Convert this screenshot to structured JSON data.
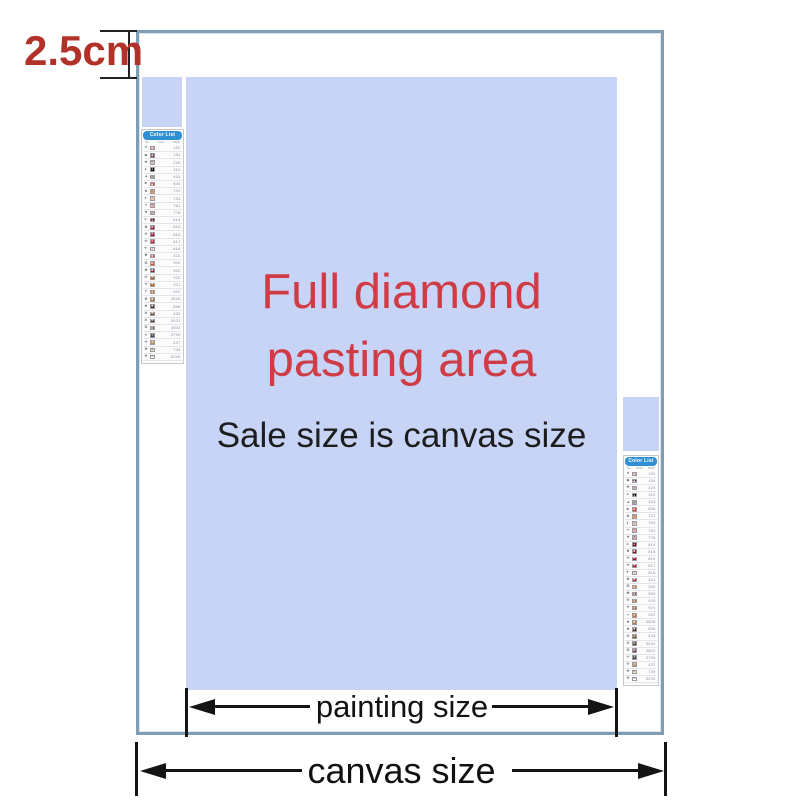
{
  "annotations": {
    "margin_label": "2.5cm",
    "painting_size_label": "painting size",
    "canvas_size_label": "canvas size"
  },
  "center": {
    "title_line1": "Full diamond",
    "title_line2": "pasting area",
    "subtitle": "Sale size is canvas size"
  },
  "colors": {
    "pasting_area_fill": "#c8d4f6",
    "canvas_border": "#7f9eb5",
    "title_red": "#d03c45",
    "margin_red": "#b23128",
    "dimension_text": "#111111",
    "color_list_header_bg": "#2e8fd2"
  },
  "color_list": {
    "title": "Color List",
    "columns": [
      "No",
      "Color",
      "DMC"
    ],
    "rows": [
      {
        "symbol": "★",
        "color": "#d98c8c",
        "code": "152"
      },
      {
        "symbol": "◆",
        "color": "#5a2b45",
        "code": "154"
      },
      {
        "symbol": "✚",
        "color": "#efc7c7",
        "code": "225"
      },
      {
        "symbol": "●",
        "color": "#000000",
        "code": "310"
      },
      {
        "symbol": "▲",
        "color": "#aaa8a0",
        "code": "453"
      },
      {
        "symbol": "■",
        "color": "#e8312a",
        "code": "606"
      },
      {
        "symbol": "✿",
        "color": "#f2a04d",
        "code": "722"
      },
      {
        "symbol": "♦",
        "color": "#f6cdb9",
        "code": "754"
      },
      {
        "symbol": "✦",
        "color": "#f2aaa5",
        "code": "761"
      },
      {
        "symbol": "❖",
        "color": "#d9adb9",
        "code": "778"
      },
      {
        "symbol": "♠",
        "color": "#700012",
        "code": "814"
      },
      {
        "symbol": "✖",
        "color": "#8b0c22",
        "code": "815"
      },
      {
        "symbol": "✙",
        "color": "#a00d28",
        "code": "816"
      },
      {
        "symbol": "✜",
        "color": "#c40a24",
        "code": "817"
      },
      {
        "symbol": "♥",
        "color": "#f9dada",
        "code": "818"
      },
      {
        "symbol": "✺",
        "color": "#c72b3b",
        "code": "321"
      },
      {
        "symbol": "✪",
        "color": "#cf5a10",
        "code": "900"
      },
      {
        "symbol": "✽",
        "color": "#7c2437",
        "code": "902"
      },
      {
        "symbol": "✠",
        "color": "#a85415",
        "code": "920"
      },
      {
        "symbol": "✷",
        "color": "#c06317",
        "code": "921"
      },
      {
        "symbol": "✶",
        "color": "#dd7b32",
        "code": "922"
      },
      {
        "symbol": "✸",
        "color": "#b07a3d",
        "code": "3826"
      },
      {
        "symbol": "✹",
        "color": "#4a2b14",
        "code": "898"
      },
      {
        "symbol": "✻",
        "color": "#7a4f23",
        "code": "433"
      },
      {
        "symbol": "✼",
        "color": "#4e3e2c",
        "code": "3031"
      },
      {
        "symbol": "❂",
        "color": "#73374b",
        "code": "3802"
      },
      {
        "symbol": "✢",
        "color": "#454442",
        "code": "3799"
      },
      {
        "symbol": "✣",
        "color": "#c08d57",
        "code": "437"
      },
      {
        "symbol": "✤",
        "color": "#f4e3c1",
        "code": "739"
      },
      {
        "symbol": "✥",
        "color": "#ffffff",
        "code": "5200"
      }
    ]
  }
}
